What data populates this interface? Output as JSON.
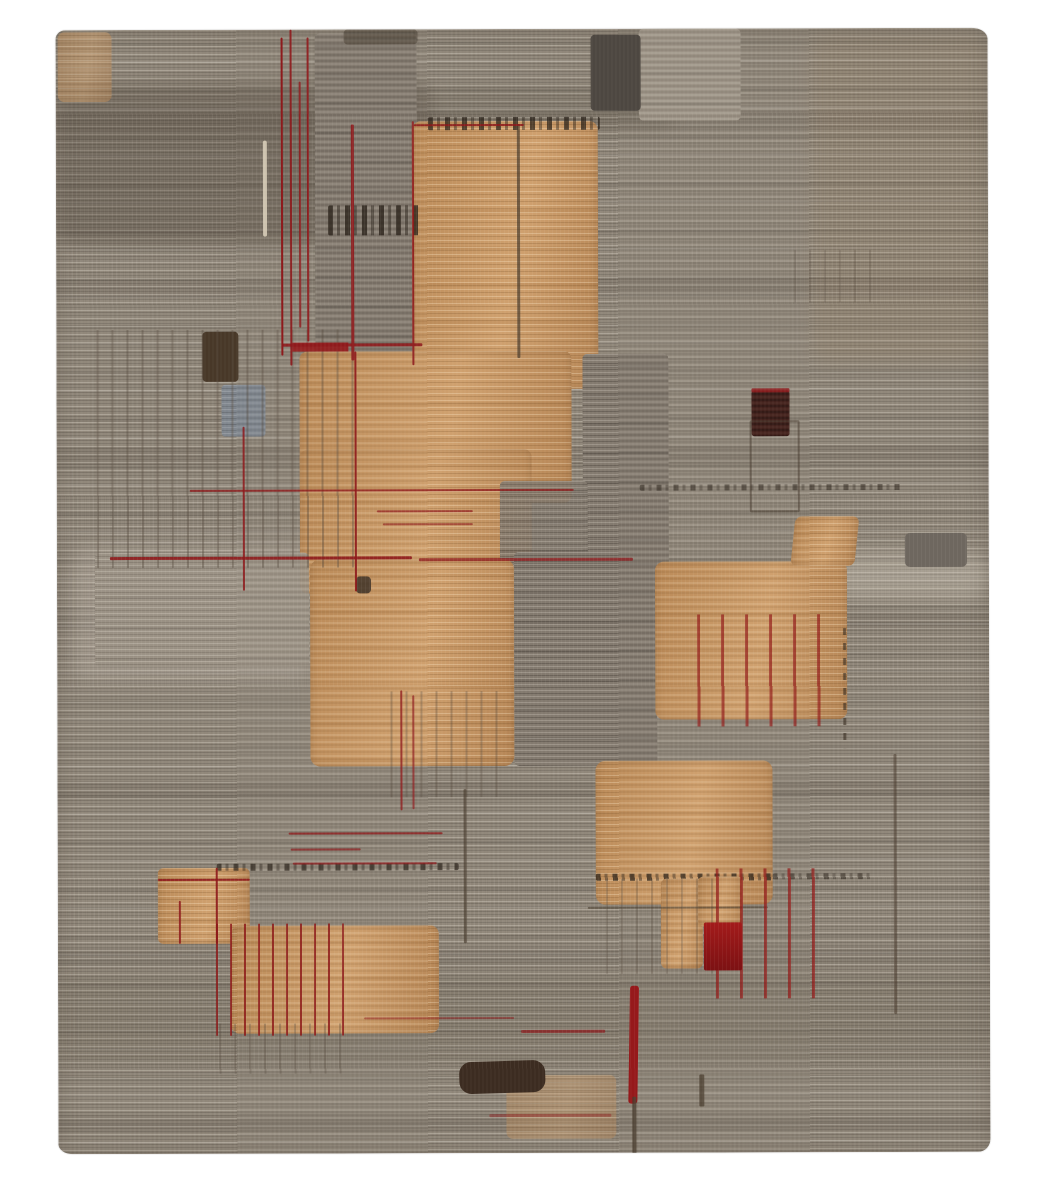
{
  "scene": {
    "description": "Photograph of a contemporary hand-knotted area rug: warm gray horizontally-striated ground, camel-tan rectangular blocks, thin deep-red accent lines, dark brown patches, on a plain white backdrop",
    "canvas": {
      "width": 1040,
      "height": 1200,
      "background": "#ffffff"
    },
    "rug": {
      "x": 57,
      "y": 29,
      "width": 932,
      "height": 1124,
      "base_color": "#8e8578"
    },
    "palette": {
      "ground_gray": "#8e8578",
      "ground_light": "#a79d90",
      "ground_dark": "#6e655a",
      "panel_gray": "#837a6f",
      "panel_gray_light": "#9b9285",
      "panel_gray_blue": "#7e8792",
      "tan": "#c49565",
      "tan_highlight": "#dcb487",
      "tan_shadow": "#a87c4b",
      "accent_red": "#8e1a1c",
      "accent_red_bright": "#a31b1b",
      "dark_brown": "#3c2c21",
      "maroon_brown": "#41211c",
      "cream": "#ddd2bd"
    },
    "shapes": [
      {
        "name": "shade-zone-topleft-dark",
        "k": "zone",
        "x": 0,
        "y": 55,
        "w": 380,
        "h": 160,
        "bg": "rgba(62,53,44,0.30)"
      },
      {
        "name": "shade-zone-top-dark-row",
        "k": "zone",
        "x": 380,
        "y": 60,
        "w": 240,
        "h": 40,
        "bg": "rgba(70,60,50,0.16)"
      },
      {
        "name": "shade-zone-topright-warm",
        "k": "zone",
        "x": 755,
        "y": 5,
        "w": 177,
        "h": 330,
        "bg": "rgba(152,117,84,0.14)"
      },
      {
        "name": "shade-zone-left-light",
        "k": "zone",
        "x": 15,
        "y": 515,
        "w": 240,
        "h": 135,
        "bg": "rgba(222,212,198,0.20)"
      },
      {
        "name": "shade-zone-bottom-dark",
        "k": "zone",
        "x": 0,
        "y": 945,
        "w": 932,
        "h": 90,
        "bg": "rgba(64,54,44,0.12)"
      },
      {
        "name": "shade-zone-right-light",
        "k": "zone",
        "x": 778,
        "y": 523,
        "w": 154,
        "h": 48,
        "bg": "rgba(224,214,200,0.28)"
      },
      {
        "name": "gray-panel-top",
        "k": "gray",
        "x": 259,
        "y": 4,
        "w": 102,
        "h": 342
      },
      {
        "name": "gray-panel-topright",
        "k": "gray-light",
        "x": 583,
        "y": 0,
        "w": 102,
        "h": 92
      },
      {
        "name": "dark-block-top",
        "k": "dark",
        "x": 535,
        "y": 6,
        "w": 50,
        "h": 76,
        "bg": "#4d4741"
      },
      {
        "name": "dark-strip-top",
        "k": "dark",
        "x": 288,
        "y": 0,
        "w": 74,
        "h": 15,
        "o": 0.5
      },
      {
        "name": "tan-wash-topleft",
        "k": "tan tan-soft",
        "x": 2,
        "y": 2,
        "w": 54,
        "h": 70,
        "o": 0.55
      },
      {
        "name": "tan-block-main",
        "k": "tan",
        "x": 356,
        "y": 92,
        "w": 186,
        "h": 268,
        "r": "9px"
      },
      {
        "name": "speckle-row-top",
        "k": "speckle-h",
        "x": 372,
        "y": 88,
        "w": 172,
        "h": 13,
        "o": 0.85
      },
      {
        "name": "speckle-band-left",
        "k": "speckle-h",
        "x": 272,
        "y": 176,
        "w": 92,
        "h": 30,
        "o": 0.9
      },
      {
        "name": "tan-block-upper2",
        "k": "tan",
        "x": 243,
        "y": 322,
        "w": 272,
        "h": 152,
        "r": "8px"
      },
      {
        "name": "tan-block-upper2b",
        "k": "tan",
        "x": 243,
        "y": 420,
        "w": 232,
        "h": 144,
        "r": "8px"
      },
      {
        "name": "gray-panel-mid1",
        "k": "gray",
        "x": 526,
        "y": 325,
        "w": 86,
        "h": 238
      },
      {
        "name": "gray-patch-mid",
        "k": "gray",
        "x": 443,
        "y": 452,
        "w": 88,
        "h": 112,
        "o": 0.88
      },
      {
        "name": "gray-panel-leftmid",
        "k": "gray-light",
        "x": 38,
        "y": 523,
        "w": 214,
        "h": 114,
        "o": 0.9
      },
      {
        "name": "tan-block-center",
        "k": "tan",
        "x": 253,
        "y": 530,
        "w": 204,
        "h": 207,
        "r": "10px"
      },
      {
        "name": "gray-panel-center",
        "k": "gray",
        "x": 457,
        "y": 523,
        "w": 143,
        "h": 214
      },
      {
        "name": "tan-block-right",
        "k": "tan",
        "x": 598,
        "y": 533,
        "w": 192,
        "h": 158,
        "r": "9px"
      },
      {
        "name": "tan-trapezoid",
        "k": "tan",
        "x": 736,
        "y": 488,
        "w": 64,
        "h": 50,
        "rot": "skewX(-6deg)"
      },
      {
        "name": "gray-block-right-small",
        "k": "gray",
        "x": 848,
        "y": 505,
        "w": 62,
        "h": 34,
        "bg": "#6e675f"
      },
      {
        "name": "maroon-block",
        "k": "maroon",
        "x": 695,
        "y": 362,
        "w": 38,
        "h": 46
      },
      {
        "name": "red-dash-row-maroon-top",
        "k": "red-line",
        "x": 695,
        "y": 360,
        "w": 38,
        "h": 4,
        "o": 0.85
      },
      {
        "name": "outline-box-right",
        "k": "outline",
        "x": 693,
        "y": 392,
        "w": 46,
        "h": 88
      },
      {
        "name": "gray-blue-square",
        "k": "gray-blue",
        "x": 165,
        "y": 355,
        "w": 44,
        "h": 52,
        "o": 0.85
      },
      {
        "name": "dark-square-left",
        "k": "dark",
        "x": 146,
        "y": 302,
        "w": 36,
        "h": 50,
        "bg": "#483828"
      },
      {
        "name": "vstripes-left-grid",
        "k": "vstripes-gray",
        "x": 40,
        "y": 300,
        "w": 262,
        "h": 238
      },
      {
        "name": "tan-block-lower",
        "k": "tan",
        "x": 538,
        "y": 732,
        "w": 177,
        "h": 144,
        "r": "10px"
      },
      {
        "name": "speckle-row-lowertan-bottom",
        "k": "speckle-h",
        "x": 538,
        "y": 845,
        "w": 177,
        "h": 7,
        "o": 0.85
      },
      {
        "name": "speckle-row-lowertan-right",
        "k": "speckle-h",
        "x": 715,
        "y": 845,
        "w": 100,
        "h": 6,
        "o": 0.6
      },
      {
        "name": "tan-patch-lower-left",
        "k": "tan",
        "x": 603,
        "y": 850,
        "w": 42,
        "h": 90,
        "r": "6px"
      },
      {
        "name": "tan-patch-lower-left2",
        "k": "tan",
        "x": 640,
        "y": 848,
        "w": 44,
        "h": 50,
        "r": "6px"
      },
      {
        "name": "vstripes-lowertan",
        "k": "vstripes-gray",
        "x": 548,
        "y": 850,
        "w": 120,
        "h": 95,
        "o": 0.7
      },
      {
        "name": "dark-line-lowertan-h",
        "k": "dark-line",
        "x": 530,
        "y": 878,
        "w": 180,
        "h": 2,
        "o": 0.6
      },
      {
        "name": "tan-block-small-left",
        "k": "tan",
        "x": 100,
        "y": 838,
        "w": 92,
        "h": 76,
        "r": "6px"
      },
      {
        "name": "tan-block-bottom",
        "k": "tan",
        "x": 173,
        "y": 896,
        "w": 208,
        "h": 108,
        "r": "9px"
      },
      {
        "name": "tan-wash-bottomedge",
        "k": "tan tan-soft",
        "x": 448,
        "y": 1046,
        "w": 110,
        "h": 64,
        "o": 0.45
      },
      {
        "name": "vstripes-below-center",
        "k": "vstripes-gray",
        "x": 333,
        "y": 662,
        "w": 120,
        "h": 106,
        "o": 0.85
      },
      {
        "name": "vstripes-below-bottom",
        "k": "vstripes-gray",
        "x": 161,
        "y": 994,
        "w": 124,
        "h": 50,
        "o": 0.8
      },
      {
        "name": "dark-dash-col-right",
        "k": "vstripes-gray",
        "x": 738,
        "y": 222,
        "w": 78,
        "h": 52,
        "o": 0.6
      },
      {
        "name": "speckle-row-right",
        "k": "speckle-h",
        "x": 583,
        "y": 456,
        "w": 262,
        "h": 6,
        "o": 0.6
      },
      {
        "name": "speckle-row-midleft",
        "k": "speckle-h",
        "x": 159,
        "y": 834,
        "w": 242,
        "h": 7,
        "o": 0.8
      },
      {
        "name": "dark-line-tan1",
        "k": "dark-line",
        "x": 461,
        "y": 95,
        "w": 3,
        "h": 234,
        "o": 0.7
      },
      {
        "name": "dark-line-left",
        "k": "dark-line",
        "x": 406,
        "y": 760,
        "w": 3,
        "h": 154,
        "o": 0.65
      },
      {
        "name": "dark-line-right",
        "k": "dark-line",
        "x": 836,
        "y": 726,
        "w": 3,
        "h": 260,
        "o": 0.55
      },
      {
        "name": "dash-v-right-tan",
        "k": "dash-v",
        "x": 786,
        "y": 600,
        "w": 3,
        "h": 120,
        "o": 0.8
      },
      {
        "name": "dark-blob-bottom",
        "k": "dark",
        "x": 401,
        "y": 1032,
        "w": 86,
        "h": 32,
        "r": "12px",
        "bg": "#3c2c21",
        "rot": "rotate(-1.5deg)"
      },
      {
        "name": "dark-glyph",
        "k": "dark",
        "x": 299,
        "y": 547,
        "w": 15,
        "h": 17,
        "o": 0.85,
        "bg": "#3e3328"
      },
      {
        "name": "light-line-topleft",
        "k": "light-line",
        "x": 207,
        "y": 111,
        "w": 4,
        "h": 96,
        "o": 0.85
      },
      {
        "name": "red-line-v1",
        "k": "red-line",
        "x": 225,
        "y": 8,
        "w": 2,
        "h": 318
      },
      {
        "name": "red-line-v2",
        "k": "red-line",
        "x": 234,
        "y": 0,
        "w": 2,
        "h": 336,
        "o": 0.9
      },
      {
        "name": "red-line-v3",
        "k": "red-line",
        "x": 243,
        "y": 52,
        "w": 2,
        "h": 246,
        "o": 0.85
      },
      {
        "name": "red-line-v4",
        "k": "red-line",
        "x": 251,
        "y": 8,
        "w": 2,
        "h": 304,
        "o": 0.95
      },
      {
        "name": "red-bar-cluster",
        "k": "red",
        "x": 236,
        "y": 313,
        "w": 56,
        "h": 9,
        "o": 0.9
      },
      {
        "name": "red-line-h1",
        "k": "red-line",
        "x": 226,
        "y": 314,
        "w": 140,
        "h": 3,
        "o": 0.9
      },
      {
        "name": "red-line-v5",
        "k": "red-line",
        "x": 295,
        "y": 95,
        "w": 3,
        "h": 236,
        "o": 0.9
      },
      {
        "name": "red-line-v6",
        "k": "red-line",
        "x": 356,
        "y": 92,
        "w": 2,
        "h": 244,
        "o": 0.9
      },
      {
        "name": "red-line-h2",
        "k": "red-line",
        "x": 358,
        "y": 95,
        "w": 110,
        "h": 2,
        "o": 0.85
      },
      {
        "name": "red-line-v7",
        "k": "red-line",
        "x": 186,
        "y": 397,
        "w": 2,
        "h": 164,
        "o": 0.85
      },
      {
        "name": "red-line-v8",
        "k": "red-line",
        "x": 298,
        "y": 322,
        "w": 2,
        "h": 240,
        "o": 0.9
      },
      {
        "name": "red-line-h3",
        "k": "red-line",
        "x": 133,
        "y": 460,
        "w": 384,
        "h": 2,
        "o": 0.8
      },
      {
        "name": "red-line-h4a",
        "k": "red-line",
        "x": 53,
        "y": 527,
        "w": 302,
        "h": 3,
        "o": 0.9
      },
      {
        "name": "red-line-h4b",
        "k": "red-line",
        "x": 362,
        "y": 529,
        "w": 214,
        "h": 3,
        "o": 0.75
      },
      {
        "name": "red-scribble1",
        "k": "red-line",
        "x": 320,
        "y": 481,
        "w": 96,
        "h": 2,
        "o": 0.7
      },
      {
        "name": "red-scribble2",
        "k": "red-line",
        "x": 326,
        "y": 494,
        "w": 90,
        "h": 2,
        "o": 0.6
      },
      {
        "name": "red-line-v9",
        "k": "red-line",
        "x": 343,
        "y": 661,
        "w": 2,
        "h": 120,
        "o": 0.8
      },
      {
        "name": "red-line-v10",
        "k": "red-line",
        "x": 355,
        "y": 666,
        "w": 2,
        "h": 114,
        "o": 0.7
      },
      {
        "name": "red-stripes-righttan",
        "k": "vstripes-red-sparse",
        "x": 640,
        "y": 586,
        "w": 138,
        "h": 112,
        "o": 0.85
      },
      {
        "name": "red-line-smalltan-h",
        "k": "red-line",
        "x": 100,
        "y": 849,
        "w": 92,
        "h": 2,
        "o": 0.9
      },
      {
        "name": "red-line-smalltan-v",
        "k": "red-line",
        "x": 158,
        "y": 838,
        "w": 2,
        "h": 76,
        "o": 0.9
      },
      {
        "name": "red-line-smalltan-v2",
        "k": "red-line",
        "x": 121,
        "y": 871,
        "w": 2,
        "h": 43,
        "o": 0.85
      },
      {
        "name": "red-stripes-bottomtan",
        "k": "vstripes-red",
        "x": 158,
        "y": 894,
        "w": 128,
        "h": 112
      },
      {
        "name": "red-stripes-bottomright",
        "k": "vstripes-red-sparse",
        "x": 658,
        "y": 840,
        "w": 114,
        "h": 130,
        "o": 0.9
      },
      {
        "name": "red-box-solid",
        "k": "red",
        "x": 646,
        "y": 894,
        "w": 38,
        "h": 48,
        "r": "2px",
        "bg": "linear-gradient(180deg,#a31b1b,#7c1113)"
      },
      {
        "name": "red-bar-bottom",
        "k": "red",
        "x": 571,
        "y": 957,
        "w": 9,
        "h": 118,
        "r": "3px",
        "rot": "rotate(1deg)"
      },
      {
        "name": "dark-tail-bottom",
        "k": "dark-line",
        "x": 574,
        "y": 1068,
        "w": 4,
        "h": 60,
        "o": 0.8
      },
      {
        "name": "dark-tick-bottom",
        "k": "dark-line",
        "x": 641,
        "y": 1046,
        "w": 5,
        "h": 32,
        "o": 0.75
      },
      {
        "name": "red-line-h5",
        "k": "red-line",
        "x": 231,
        "y": 803,
        "w": 154,
        "h": 2,
        "o": 0.8
      },
      {
        "name": "red-line-h6",
        "k": "red-line",
        "x": 233,
        "y": 819,
        "w": 70,
        "h": 2,
        "o": 0.7
      },
      {
        "name": "red-line-h7",
        "k": "red-line",
        "x": 235,
        "y": 833,
        "w": 144,
        "h": 2,
        "o": 0.75
      },
      {
        "name": "red-line-h8",
        "k": "red-line",
        "x": 463,
        "y": 1001,
        "w": 84,
        "h": 3,
        "o": 0.7
      },
      {
        "name": "red-line-h10",
        "k": "red-line",
        "x": 306,
        "y": 988,
        "w": 150,
        "h": 2,
        "o": 0.5
      },
      {
        "name": "red-line-h9",
        "k": "red-line",
        "x": 431,
        "y": 1085,
        "w": 122,
        "h": 3,
        "o": 0.45
      }
    ]
  }
}
